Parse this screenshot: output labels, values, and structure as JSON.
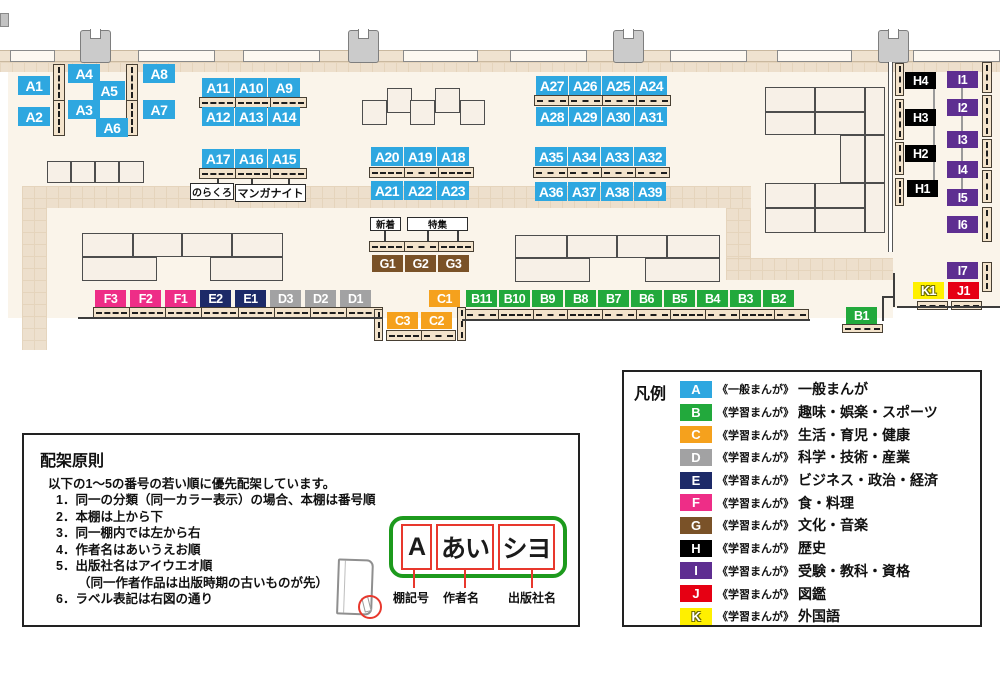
{
  "colors": {
    "A": "#2ea7e0",
    "B": "#22a93c",
    "C": "#f5a11d",
    "D": "#a2a2a3",
    "E": "#1d2a68",
    "F": "#ee2d87",
    "G": "#7a5228",
    "H": "#000000",
    "I": "#5e2e91",
    "J": "#e60013",
    "K": "#fff000"
  },
  "map": {
    "floors": [
      {
        "x": 8,
        "y": 52,
        "w": 885,
        "h": 266
      },
      {
        "x": 891,
        "y": 52,
        "w": 109,
        "h": 256
      }
    ],
    "walkways": [
      {
        "x": 0,
        "y": 62,
        "w": 1000,
        "h": 10
      },
      {
        "x": 22,
        "y": 186,
        "w": 729,
        "h": 22
      },
      {
        "x": 22,
        "y": 208,
        "w": 25,
        "h": 142
      },
      {
        "x": 726,
        "y": 208,
        "w": 25,
        "h": 52
      },
      {
        "x": 726,
        "y": 258,
        "w": 167,
        "h": 22
      }
    ],
    "wallband": {
      "x": 0,
      "y": 50,
      "w": 1000,
      "h": 12
    },
    "windows": [
      {
        "x": 10,
        "w": 45
      },
      {
        "x": 138,
        "w": 77
      },
      {
        "x": 243,
        "w": 77
      },
      {
        "x": 403,
        "w": 75
      },
      {
        "x": 510,
        "w": 77
      },
      {
        "x": 670,
        "w": 77
      },
      {
        "x": 777,
        "w": 75
      },
      {
        "x": 913,
        "w": 87
      }
    ],
    "pillars": [
      {
        "x": 80
      },
      {
        "x": 348
      },
      {
        "x": 613
      },
      {
        "x": 878
      }
    ],
    "stubs": [
      {
        "x": 0,
        "y": 13,
        "w": 9,
        "h": 14
      }
    ],
    "tables": [
      {
        "x": 47,
        "y": 161,
        "w": 24,
        "h": 22
      },
      {
        "x": 71,
        "y": 161,
        "w": 24,
        "h": 22
      },
      {
        "x": 95,
        "y": 161,
        "w": 24,
        "h": 22
      },
      {
        "x": 119,
        "y": 161,
        "w": 25,
        "h": 22
      },
      {
        "x": 362,
        "y": 100,
        "w": 25,
        "h": 25
      },
      {
        "x": 387,
        "y": 88,
        "w": 25,
        "h": 25
      },
      {
        "x": 410,
        "y": 100,
        "w": 25,
        "h": 25
      },
      {
        "x": 435,
        "y": 88,
        "w": 25,
        "h": 25
      },
      {
        "x": 460,
        "y": 100,
        "w": 25,
        "h": 25
      },
      {
        "x": 82,
        "y": 233,
        "w": 51,
        "h": 24
      },
      {
        "x": 133,
        "y": 233,
        "w": 49,
        "h": 24
      },
      {
        "x": 182,
        "y": 233,
        "w": 50,
        "h": 24
      },
      {
        "x": 232,
        "y": 233,
        "w": 51,
        "h": 24
      },
      {
        "x": 82,
        "y": 257,
        "w": 75,
        "h": 24
      },
      {
        "x": 210,
        "y": 257,
        "w": 73,
        "h": 24
      },
      {
        "x": 515,
        "y": 235,
        "w": 52,
        "h": 23
      },
      {
        "x": 567,
        "y": 235,
        "w": 50,
        "h": 23
      },
      {
        "x": 617,
        "y": 235,
        "w": 50,
        "h": 23
      },
      {
        "x": 667,
        "y": 235,
        "w": 53,
        "h": 23
      },
      {
        "x": 515,
        "y": 258,
        "w": 75,
        "h": 24
      },
      {
        "x": 645,
        "y": 258,
        "w": 75,
        "h": 24
      },
      {
        "x": 765,
        "y": 87,
        "w": 50,
        "h": 25
      },
      {
        "x": 815,
        "y": 87,
        "w": 50,
        "h": 25
      },
      {
        "x": 765,
        "y": 112,
        "w": 50,
        "h": 23
      },
      {
        "x": 815,
        "y": 112,
        "w": 50,
        "h": 23
      },
      {
        "x": 865,
        "y": 87,
        "w": 20,
        "h": 48
      },
      {
        "x": 840,
        "y": 135,
        "w": 25,
        "h": 48
      },
      {
        "x": 865,
        "y": 135,
        "w": 20,
        "h": 48
      },
      {
        "x": 765,
        "y": 183,
        "w": 50,
        "h": 25
      },
      {
        "x": 815,
        "y": 183,
        "w": 50,
        "h": 25
      },
      {
        "x": 765,
        "y": 208,
        "w": 50,
        "h": 25
      },
      {
        "x": 815,
        "y": 208,
        "w": 50,
        "h": 25
      },
      {
        "x": 865,
        "y": 183,
        "w": 20,
        "h": 50
      }
    ],
    "shelves": [
      {
        "x": 199,
        "y": 97,
        "w": 108,
        "h": 11,
        "dir": "h",
        "segs": 3
      },
      {
        "x": 199,
        "y": 168,
        "w": 108,
        "h": 11,
        "dir": "h",
        "segs": 3
      },
      {
        "x": 369,
        "y": 167,
        "w": 105,
        "h": 11,
        "dir": "h",
        "segs": 3
      },
      {
        "x": 534,
        "y": 95,
        "w": 137,
        "h": 11,
        "dir": "h",
        "segs": 4
      },
      {
        "x": 533,
        "y": 167,
        "w": 137,
        "h": 11,
        "dir": "h",
        "segs": 4
      },
      {
        "x": 369,
        "y": 241,
        "w": 105,
        "h": 11,
        "dir": "h",
        "segs": 3
      },
      {
        "x": 93,
        "y": 307,
        "w": 290,
        "h": 11,
        "dir": "h",
        "segs": 8
      },
      {
        "x": 464,
        "y": 309,
        "w": 345,
        "h": 11,
        "dir": "h",
        "segs": 10
      },
      {
        "x": 386,
        "y": 330,
        "w": 70,
        "h": 11,
        "dir": "h",
        "segs": 2
      },
      {
        "x": 842,
        "y": 324,
        "w": 41,
        "h": 9,
        "dir": "h",
        "segs": 1
      },
      {
        "x": 917,
        "y": 301,
        "w": 31,
        "h": 9,
        "dir": "h",
        "segs": 1
      },
      {
        "x": 951,
        "y": 301,
        "w": 31,
        "h": 9,
        "dir": "h",
        "segs": 1
      },
      {
        "x": 53,
        "y": 64,
        "w": 12,
        "h": 72,
        "dir": "v",
        "segs": 2
      },
      {
        "x": 126,
        "y": 64,
        "w": 12,
        "h": 72,
        "dir": "v",
        "segs": 2
      },
      {
        "x": 374,
        "y": 309,
        "w": 9,
        "h": 32,
        "dir": "v",
        "segs": 1
      },
      {
        "x": 457,
        "y": 307,
        "w": 9,
        "h": 34,
        "dir": "v",
        "segs": 1
      },
      {
        "x": 895,
        "y": 63,
        "w": 9,
        "h": 33,
        "dir": "v",
        "segs": 1
      },
      {
        "x": 895,
        "y": 99,
        "w": 9,
        "h": 41,
        "dir": "v",
        "segs": 1
      },
      {
        "x": 895,
        "y": 142,
        "w": 9,
        "h": 33,
        "dir": "v",
        "segs": 1
      },
      {
        "x": 895,
        "y": 178,
        "w": 9,
        "h": 28,
        "dir": "v",
        "segs": 1
      },
      {
        "x": 982,
        "y": 62,
        "w": 10,
        "h": 31,
        "dir": "v",
        "segs": 1
      },
      {
        "x": 982,
        "y": 95,
        "w": 10,
        "h": 42,
        "dir": "v",
        "segs": 1
      },
      {
        "x": 982,
        "y": 139,
        "w": 10,
        "h": 29,
        "dir": "v",
        "segs": 1
      },
      {
        "x": 982,
        "y": 170,
        "w": 10,
        "h": 33,
        "dir": "v",
        "segs": 1
      },
      {
        "x": 982,
        "y": 207,
        "w": 10,
        "h": 35,
        "dir": "v",
        "segs": 1
      },
      {
        "x": 982,
        "y": 262,
        "w": 10,
        "h": 30,
        "dir": "v",
        "segs": 1
      }
    ],
    "dwalls": [
      {
        "x": 888,
        "y": 62,
        "w": 5,
        "h": 190
      }
    ],
    "wlines": [
      {
        "x": 893,
        "y": 273,
        "w": 2,
        "h": 34
      },
      {
        "x": 897,
        "y": 306,
        "w": 103,
        "h": 2
      },
      {
        "x": 882,
        "y": 296,
        "w": 13,
        "h": 2
      },
      {
        "x": 882,
        "y": 296,
        "w": 2,
        "h": 25
      },
      {
        "x": 78,
        "y": 317,
        "w": 305,
        "h": 2
      },
      {
        "x": 462,
        "y": 319,
        "w": 348,
        "h": 2
      }
    ],
    "connectors": [
      {
        "x": 933,
        "y": 85,
        "w": 2,
        "h": 105
      },
      {
        "x": 961,
        "y": 85,
        "w": 2,
        "h": 112
      }
    ],
    "ticks": [
      {
        "x": 217,
        "y": 178,
        "w": 2,
        "h": 7
      },
      {
        "x": 251,
        "y": 179,
        "w": 2,
        "h": 7
      },
      {
        "x": 288,
        "y": 179,
        "w": 2,
        "h": 7
      },
      {
        "x": 384,
        "y": 230,
        "w": 2,
        "h": 12
      },
      {
        "x": 427,
        "y": 230,
        "w": 2,
        "h": 12
      },
      {
        "x": 457,
        "y": 230,
        "w": 2,
        "h": 12
      }
    ],
    "notes": [
      {
        "text": "のらくろ",
        "x": 190,
        "y": 183,
        "w": 44,
        "h": 17,
        "fs": 10
      },
      {
        "text": "マンガナイト",
        "x": 235,
        "y": 184,
        "w": 71,
        "h": 18,
        "fs": 11
      },
      {
        "text": "新着",
        "x": 370,
        "y": 217,
        "w": 31,
        "h": 14,
        "fs": 9.5
      },
      {
        "text": "特集",
        "x": 407,
        "y": 217,
        "w": 61,
        "h": 14,
        "fs": 9.5
      }
    ],
    "labels": [
      {
        "id": "A1",
        "x": 18,
        "y": 76
      },
      {
        "id": "A2",
        "x": 18,
        "y": 107
      },
      {
        "id": "A4",
        "x": 68,
        "y": 64
      },
      {
        "id": "A5",
        "x": 93,
        "y": 81
      },
      {
        "id": "A3",
        "x": 68,
        "y": 100
      },
      {
        "id": "A6",
        "x": 96,
        "y": 118
      },
      {
        "id": "A8",
        "x": 143,
        "y": 64
      },
      {
        "id": "A7",
        "x": 143,
        "y": 100
      },
      {
        "id": "A11",
        "x": 202,
        "y": 78
      },
      {
        "id": "A10",
        "x": 235,
        "y": 78
      },
      {
        "id": "A9",
        "x": 268,
        "y": 78
      },
      {
        "id": "A12",
        "x": 202,
        "y": 107
      },
      {
        "id": "A13",
        "x": 235,
        "y": 107
      },
      {
        "id": "A14",
        "x": 268,
        "y": 107
      },
      {
        "id": "A17",
        "x": 202,
        "y": 149
      },
      {
        "id": "A16",
        "x": 235,
        "y": 149
      },
      {
        "id": "A15",
        "x": 268,
        "y": 149
      },
      {
        "id": "A20",
        "x": 371,
        "y": 147
      },
      {
        "id": "A19",
        "x": 404,
        "y": 147
      },
      {
        "id": "A18",
        "x": 437,
        "y": 147
      },
      {
        "id": "A21",
        "x": 371,
        "y": 181
      },
      {
        "id": "A22",
        "x": 404,
        "y": 181
      },
      {
        "id": "A23",
        "x": 437,
        "y": 181
      },
      {
        "id": "A27",
        "x": 536,
        "y": 76
      },
      {
        "id": "A26",
        "x": 569,
        "y": 76
      },
      {
        "id": "A25",
        "x": 602,
        "y": 76
      },
      {
        "id": "A24",
        "x": 635,
        "y": 76
      },
      {
        "id": "A28",
        "x": 536,
        "y": 107
      },
      {
        "id": "A29",
        "x": 569,
        "y": 107
      },
      {
        "id": "A30",
        "x": 602,
        "y": 107
      },
      {
        "id": "A31",
        "x": 635,
        "y": 107
      },
      {
        "id": "A35",
        "x": 535,
        "y": 147
      },
      {
        "id": "A34",
        "x": 568,
        "y": 147
      },
      {
        "id": "A33",
        "x": 601,
        "y": 147
      },
      {
        "id": "A32",
        "x": 634,
        "y": 147
      },
      {
        "id": "A36",
        "x": 535,
        "y": 182
      },
      {
        "id": "A37",
        "x": 568,
        "y": 182
      },
      {
        "id": "A38",
        "x": 601,
        "y": 182
      },
      {
        "id": "A39",
        "x": 634,
        "y": 182
      },
      {
        "id": "G1",
        "x": 372,
        "y": 255
      },
      {
        "id": "G2",
        "x": 405,
        "y": 255
      },
      {
        "id": "G3",
        "x": 438,
        "y": 255
      },
      {
        "id": "F3",
        "x": 95,
        "y": 290
      },
      {
        "id": "F2",
        "x": 130,
        "y": 290
      },
      {
        "id": "F1",
        "x": 165,
        "y": 290
      },
      {
        "id": "E2",
        "x": 200,
        "y": 290
      },
      {
        "id": "E1",
        "x": 235,
        "y": 290
      },
      {
        "id": "D3",
        "x": 270,
        "y": 290
      },
      {
        "id": "D2",
        "x": 305,
        "y": 290
      },
      {
        "id": "D1",
        "x": 340,
        "y": 290
      },
      {
        "id": "C1",
        "x": 429,
        "y": 290
      },
      {
        "id": "C3",
        "x": 387,
        "y": 312
      },
      {
        "id": "C2",
        "x": 421,
        "y": 312
      },
      {
        "id": "B11",
        "x": 466,
        "y": 290
      },
      {
        "id": "B10",
        "x": 499,
        "y": 290
      },
      {
        "id": "B9",
        "x": 532,
        "y": 290
      },
      {
        "id": "B8",
        "x": 565,
        "y": 290
      },
      {
        "id": "B7",
        "x": 598,
        "y": 290
      },
      {
        "id": "B6",
        "x": 631,
        "y": 290
      },
      {
        "id": "B5",
        "x": 664,
        "y": 290
      },
      {
        "id": "B4",
        "x": 697,
        "y": 290
      },
      {
        "id": "B3",
        "x": 730,
        "y": 290
      },
      {
        "id": "B2",
        "x": 763,
        "y": 290
      },
      {
        "id": "B1",
        "x": 846,
        "y": 307
      },
      {
        "id": "H4",
        "x": 905,
        "y": 72
      },
      {
        "id": "H3",
        "x": 905,
        "y": 109
      },
      {
        "id": "H2",
        "x": 905,
        "y": 145
      },
      {
        "id": "H1",
        "x": 907,
        "y": 180
      },
      {
        "id": "I1",
        "x": 947,
        "y": 71
      },
      {
        "id": "I2",
        "x": 947,
        "y": 99
      },
      {
        "id": "I3",
        "x": 947,
        "y": 131
      },
      {
        "id": "I4",
        "x": 947,
        "y": 161
      },
      {
        "id": "I5",
        "x": 947,
        "y": 189
      },
      {
        "id": "I6",
        "x": 947,
        "y": 216
      },
      {
        "id": "I7",
        "x": 947,
        "y": 262
      },
      {
        "id": "K1",
        "x": 913,
        "y": 282
      },
      {
        "id": "J1",
        "x": 948,
        "y": 282
      }
    ]
  },
  "rules": {
    "title": "配架原則",
    "intro": "以下の1～5の番号の若い順に優先配架しています。",
    "items": [
      {
        "num": "1．",
        "text": "同一の分類（同一カラー表示）の場合、本棚は番号順"
      },
      {
        "num": "2．",
        "text": "本棚は上から下"
      },
      {
        "num": "3．",
        "text": "同一棚内では左から右"
      },
      {
        "num": "4．",
        "text": "作者名はあいうえお順"
      },
      {
        "num": "5．",
        "text": "出版社名はアイウエオ順"
      },
      {
        "num": "",
        "text": "（同一作者作品は出版時期の古いものが先）"
      },
      {
        "num": "6．",
        "text": "ラベル表記は右図の通り"
      }
    ],
    "diagram": {
      "parts": [
        {
          "text": "A",
          "w": 31
        },
        {
          "text": "あい",
          "w": 58
        },
        {
          "text": "シヨ",
          "w": 57
        }
      ],
      "captions": [
        {
          "text": "棚記号",
          "x": 393,
          "y": 589
        },
        {
          "text": "作者名",
          "x": 443,
          "y": 589
        },
        {
          "text": "出版社名",
          "x": 508,
          "y": 589
        }
      ]
    }
  },
  "legend": {
    "title": "凡例",
    "items": [
      {
        "code": "A",
        "series": "《一般まんが》",
        "category": "一般まんが"
      },
      {
        "code": "B",
        "series": "《学習まんが》",
        "category": "趣味・娯楽・スポーツ"
      },
      {
        "code": "C",
        "series": "《学習まんが》",
        "category": "生活・育児・健康"
      },
      {
        "code": "D",
        "series": "《学習まんが》",
        "category": "科学・技術・産業"
      },
      {
        "code": "E",
        "series": "《学習まんが》",
        "category": "ビジネス・政治・経済"
      },
      {
        "code": "F",
        "series": "《学習まんが》",
        "category": "食・料理"
      },
      {
        "code": "G",
        "series": "《学習まんが》",
        "category": "文化・音楽"
      },
      {
        "code": "H",
        "series": "《学習まんが》",
        "category": "歴史"
      },
      {
        "code": "I",
        "series": "《学習まんが》",
        "category": "受験・教科・資格"
      },
      {
        "code": "J",
        "series": "《学習まんが》",
        "category": "図鑑"
      },
      {
        "code": "K",
        "series": "《学習まんが》",
        "category": "外国語"
      }
    ]
  }
}
